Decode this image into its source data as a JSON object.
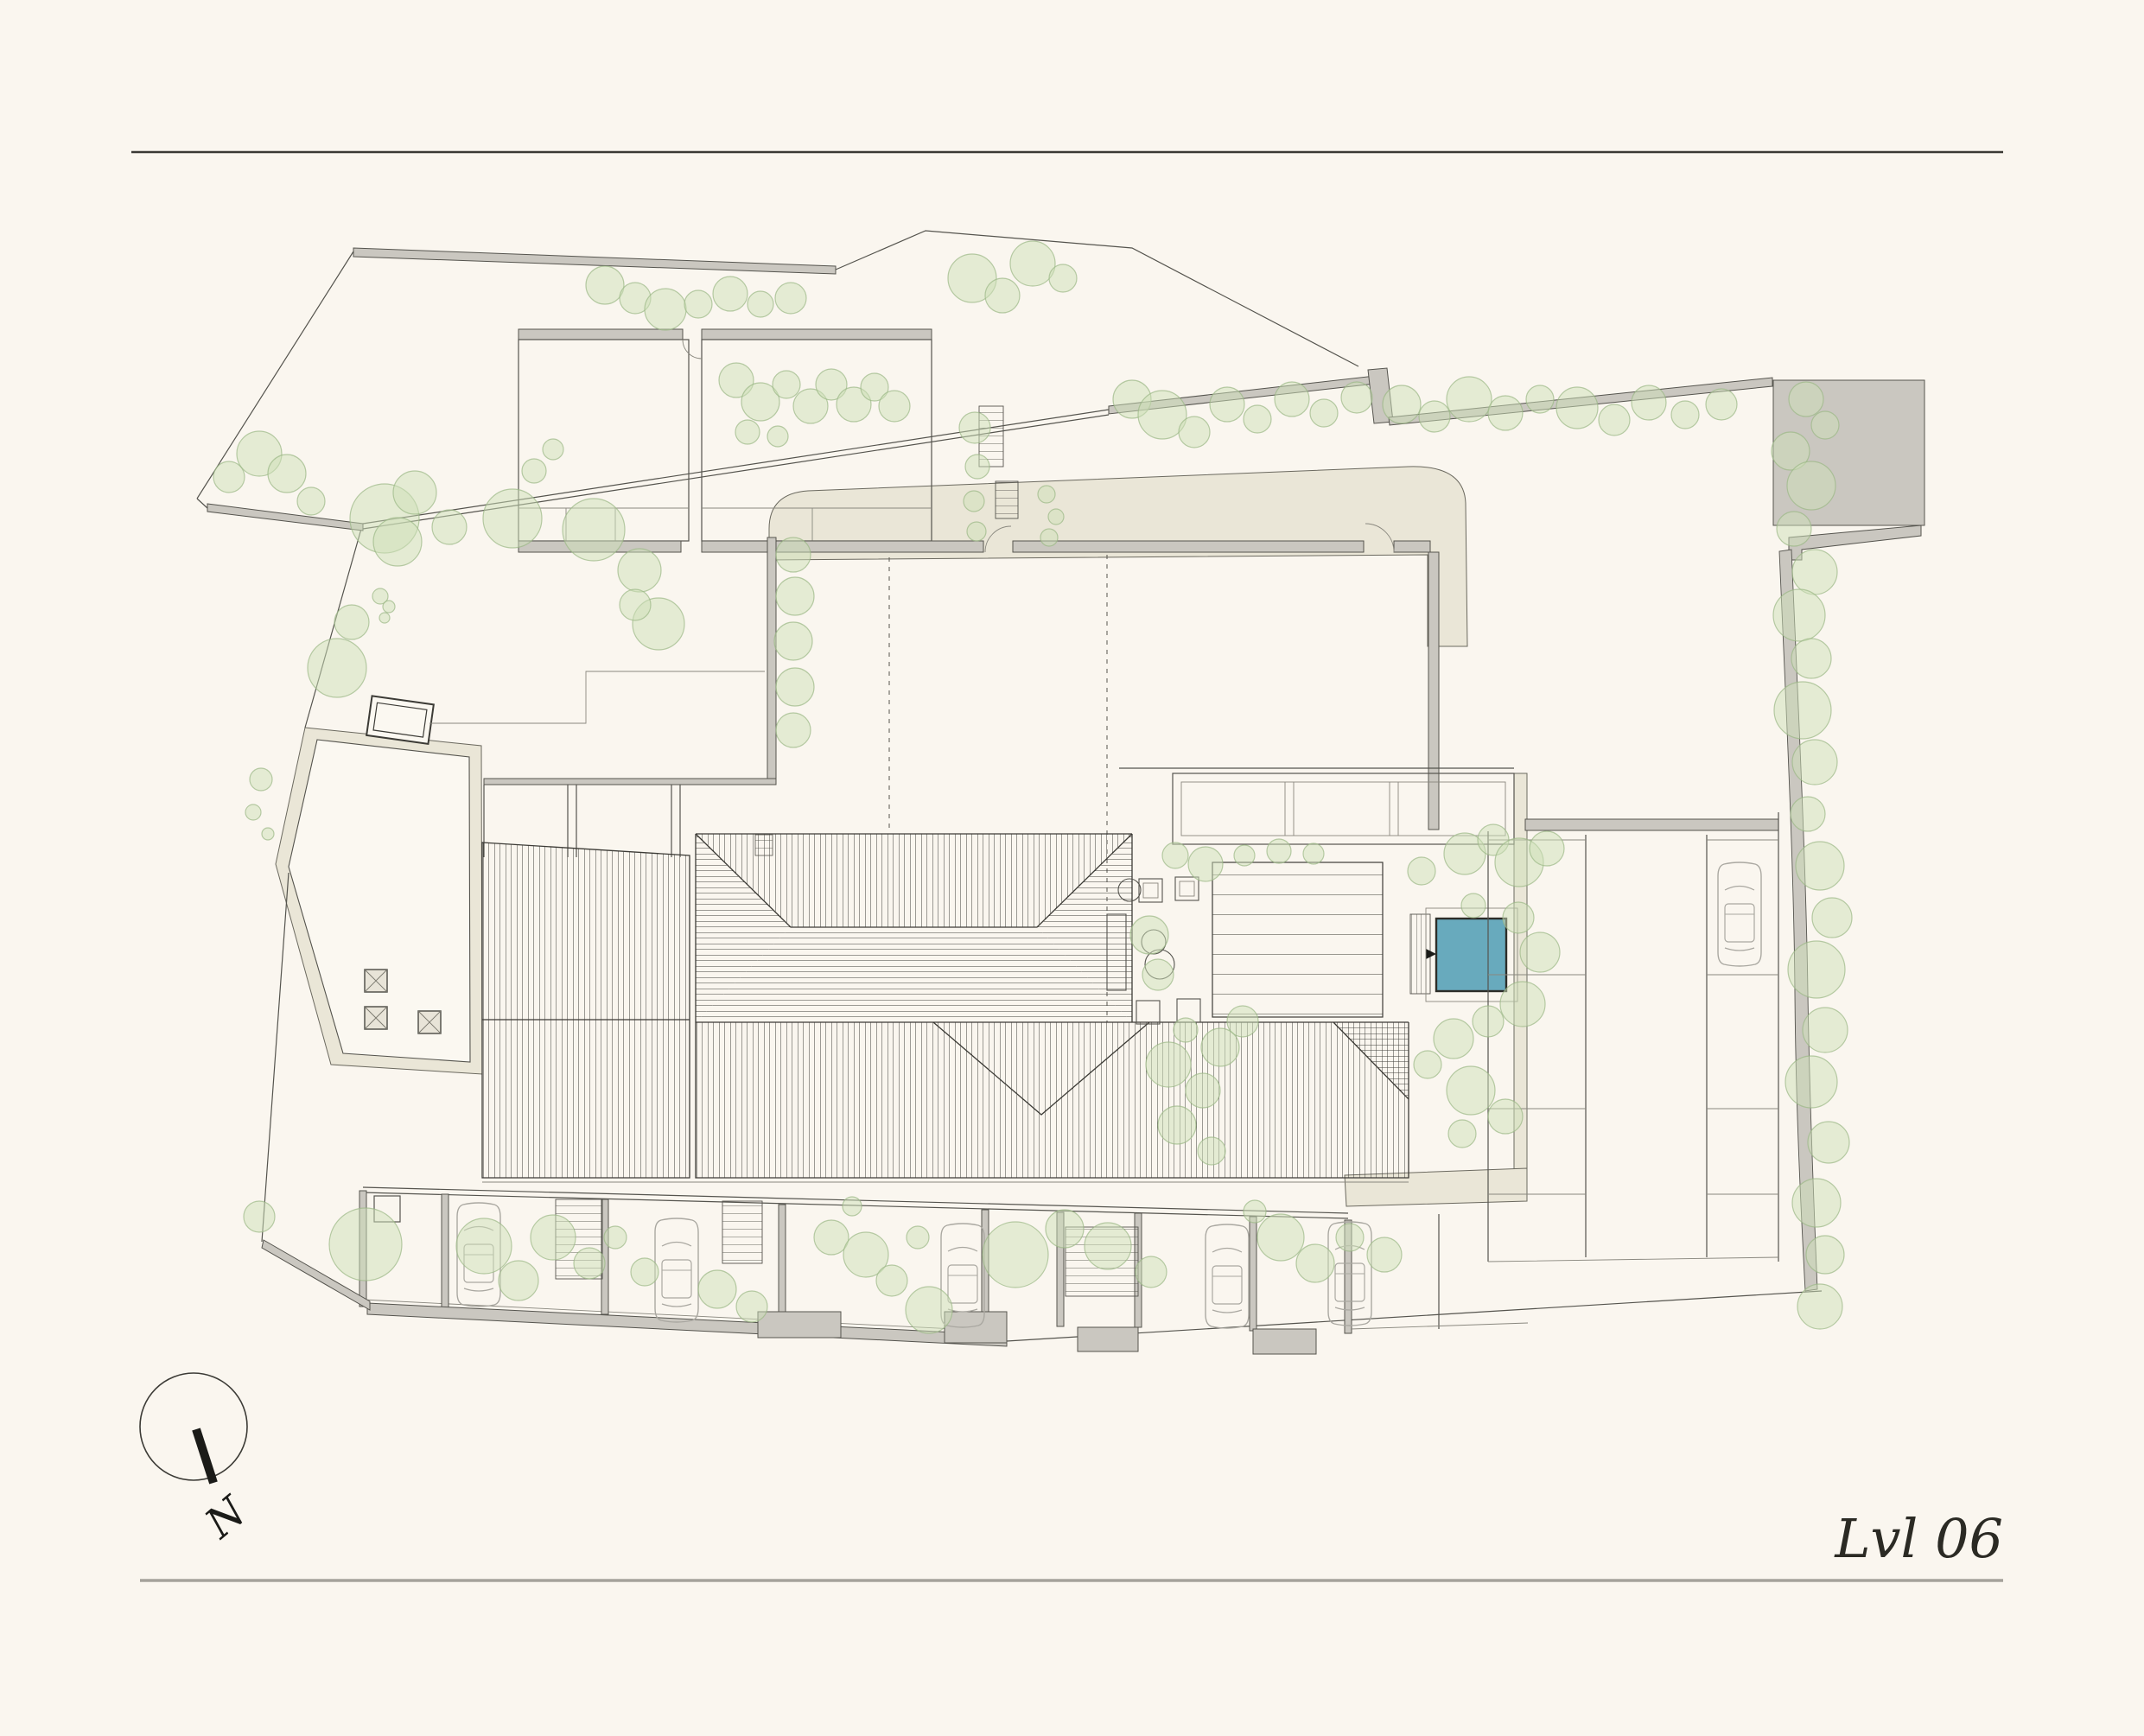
{
  "titleblock": {
    "level_label": "Lvl 06"
  },
  "compass": {
    "north_label": "N"
  },
  "colors": {
    "background": "#faf6ef",
    "pool_blue": "#68aabd",
    "tree_green": "#cde0b8",
    "tree_stroke": "#9bb886",
    "wall_gray": "#cac7c0",
    "path_beige": "#eae6d7",
    "rule_top": "#3a3934",
    "rule_bottom": "#a5a29b"
  }
}
